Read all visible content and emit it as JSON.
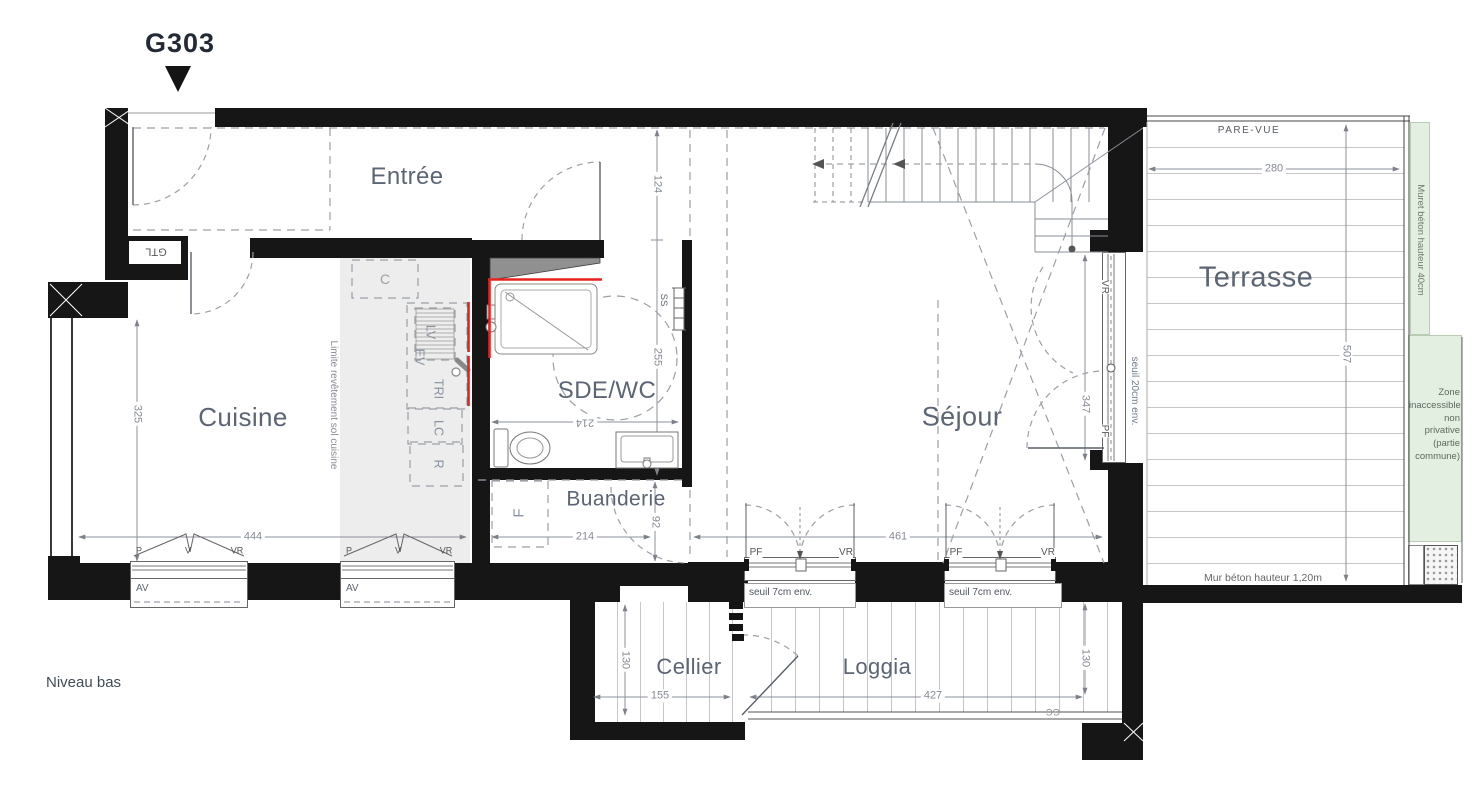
{
  "meta": {
    "unit": "G303",
    "level": "Niveau bas"
  },
  "rooms": {
    "entree": "Entrée",
    "cuisine": "Cuisine",
    "sde_wc": "SDE/WC",
    "buanderie": "Buanderie",
    "sejour": "Séjour",
    "terrasse": "Terrasse",
    "cellier": "Cellier",
    "loggia": "Loggia"
  },
  "annotations": {
    "pare_vue": "PARE-VUE",
    "muret_beton": "Muret béton hauteur 40cm",
    "zone_inaccessible": "Zone inaccessible non privative (partie commune)",
    "mur_beton": "Mur béton hauteur 1,20m",
    "limite_revetement": "Limite revêtement sol cuisine",
    "seuil_7cm": "seuil 7cm env.",
    "seuil_20cm": "seuil 20cm env."
  },
  "tags": {
    "gtl": "GTL",
    "av": "AV",
    "c": "C",
    "f": "F",
    "lv": "LV",
    "ev": "EV",
    "tri": "TRI",
    "lc": "LC",
    "r": "R",
    "ss": "SS",
    "gc": "GC",
    "p": "P",
    "v": "V",
    "vr": "VR",
    "pf": "PF"
  },
  "dims": {
    "d325": "325",
    "d444": "444",
    "d124": "124",
    "d255": "255",
    "d214": "214",
    "d92": "92",
    "d461": "461",
    "d347": "347",
    "d507": "507",
    "d280": "280",
    "d130": "130",
    "d155": "155",
    "d427": "427"
  },
  "colors": {
    "wall": "#161616",
    "room_label": "#5b6574",
    "dimension": "#858b94",
    "red_accent": "#e8211d",
    "green_zone": "#e3efe0",
    "kitchen_floor": "#ededed"
  }
}
